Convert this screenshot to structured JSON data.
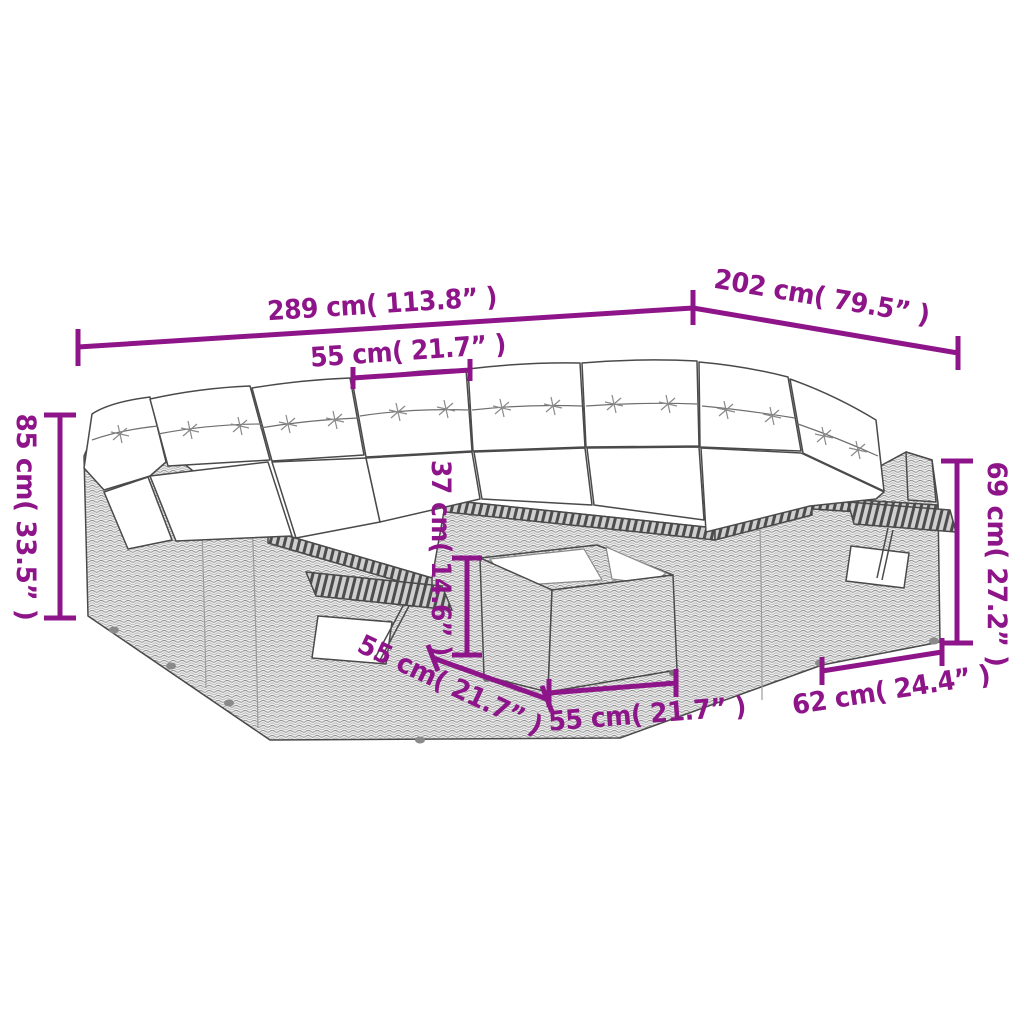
{
  "figure": {
    "type": "product-dimension-diagram",
    "subject": "poly-rattan-corner-garden-sofa-set-with-cushions-and-coffee-table",
    "colors": {
      "dimension_accent": "#8e1589",
      "line_art": "#4a4a4a",
      "wicker_fill": "#ececec",
      "cushion_fill": "#ffffff"
    }
  },
  "dimensions": {
    "overall_width": "289 cm( 113.8” )",
    "overall_depth": "202 cm( 79.5” )",
    "seat_width": "55 cm( 21.7” )",
    "back_height": "85 cm( 33.5” )",
    "arm_height": "69 cm( 27.2” )",
    "table_height": "37 cm( 14.6” )",
    "table_depth": "55 cm( 21.7” )",
    "table_width": "55 cm( 21.7” )",
    "armrest_depth": "62 cm( 24.4” )"
  }
}
